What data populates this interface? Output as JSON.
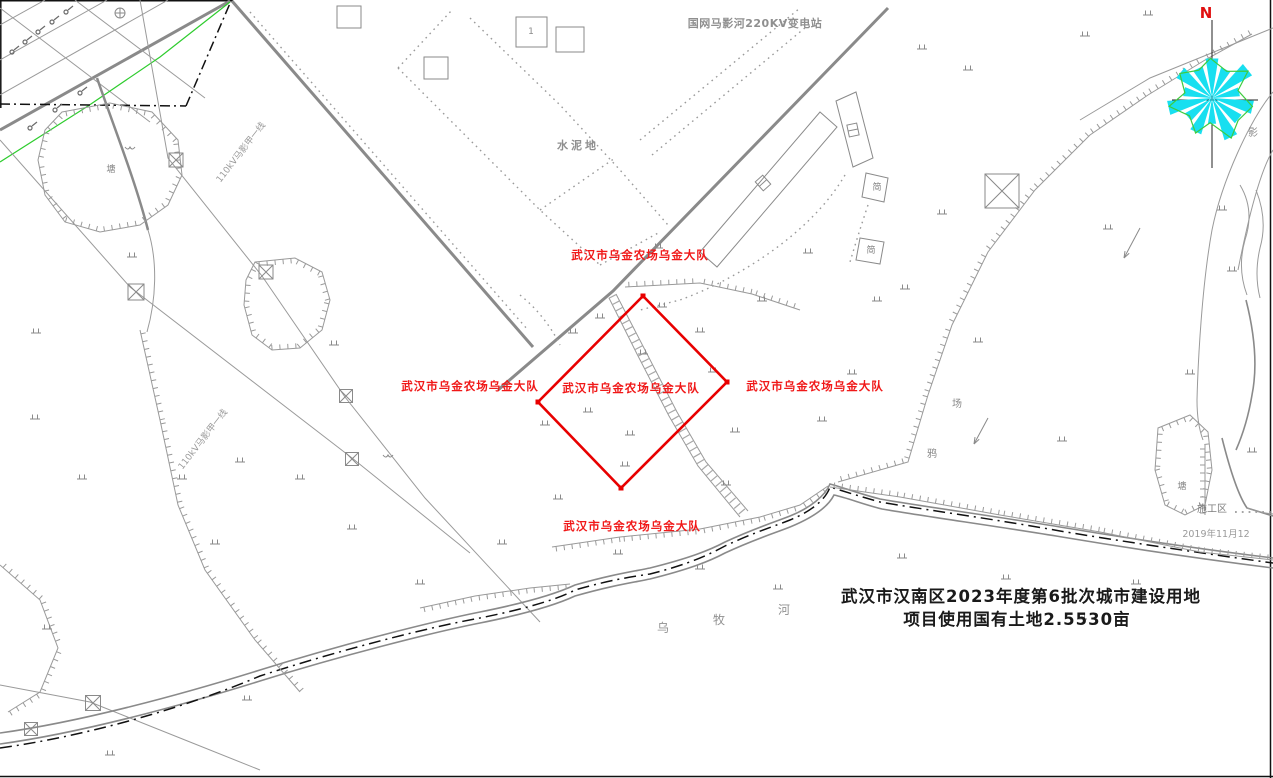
{
  "map_title": "cadastral-parcel-map",
  "compass": {
    "north_label": "N",
    "rose_color": "#18dff0",
    "rose_outline_color": "#3ecc3e",
    "north_color": "#e01010"
  },
  "parcel": {
    "outline_color": "#e80000"
  },
  "annotation": {
    "line1": "武汉市汉南区2023年度第6批次城市建设用地",
    "line2": "项目使用国有土地2.5530亩"
  },
  "labels": [
    {
      "name": "substation-label",
      "text": "国网马影河220KV变电站",
      "x": 755,
      "y": 27,
      "size": 11,
      "color": "#8f8f8f",
      "weight": 700,
      "ls": 0.5
    },
    {
      "name": "concrete-ground-label",
      "text": "水泥地",
      "x": 578,
      "y": 149,
      "size": 11,
      "color": "#8f8f8f",
      "weight": 700,
      "ls": 3
    },
    {
      "name": "brigade-label-top",
      "text": "武汉市乌金农场乌金大队",
      "x": 640,
      "y": 259,
      "size": 11.5,
      "color": "#f01818",
      "weight": 700,
      "ls": 1
    },
    {
      "name": "brigade-label-left",
      "text": "武汉市乌金农场乌金大队",
      "x": 470,
      "y": 390,
      "size": 11.5,
      "color": "#f01818",
      "weight": 700,
      "ls": 1
    },
    {
      "name": "brigade-label-center",
      "text": "武汉市乌金农场乌金大队",
      "x": 631,
      "y": 392,
      "size": 11.5,
      "color": "#f01818",
      "weight": 700,
      "ls": 1
    },
    {
      "name": "brigade-label-right",
      "text": "武汉市乌金农场乌金大队",
      "x": 815,
      "y": 390,
      "size": 11.5,
      "color": "#f01818",
      "weight": 700,
      "ls": 1
    },
    {
      "name": "brigade-label-bottom",
      "text": "武汉市乌金农场乌金大队",
      "x": 632,
      "y": 530,
      "size": 11.5,
      "color": "#f01818",
      "weight": 700,
      "ls": 1
    },
    {
      "name": "river-name-char-1",
      "text": "乌",
      "x": 663,
      "y": 632,
      "size": 12,
      "color": "#909090"
    },
    {
      "name": "river-name-char-2",
      "text": "牧",
      "x": 719,
      "y": 624,
      "size": 12,
      "color": "#909090"
    },
    {
      "name": "river-name-char-3",
      "text": "河",
      "x": 784,
      "y": 614,
      "size": 12,
      "color": "#909090"
    },
    {
      "name": "pond-label-left",
      "text": "塘",
      "x": 111,
      "y": 172,
      "size": 9,
      "color": "#808080"
    },
    {
      "name": "pond-label-right",
      "text": "塘",
      "x": 1182,
      "y": 489,
      "size": 9,
      "color": "#808080"
    },
    {
      "name": "area-char-1",
      "text": "场",
      "x": 957,
      "y": 407,
      "size": 10,
      "color": "#8a8a8a"
    },
    {
      "name": "area-char-2",
      "text": "鸦",
      "x": 932,
      "y": 457,
      "size": 10,
      "color": "#8a8a8a"
    },
    {
      "name": "area-char-3",
      "text": "影",
      "x": 1253,
      "y": 136,
      "size": 10,
      "color": "#8a8a8a"
    },
    {
      "name": "shed-label-1",
      "text": "简",
      "x": 877,
      "y": 190,
      "size": 9,
      "color": "#808080"
    },
    {
      "name": "shed-label-2",
      "text": "简",
      "x": 871,
      "y": 253,
      "size": 9,
      "color": "#808080"
    },
    {
      "name": "construction-area-label",
      "text": "施工区",
      "x": 1212,
      "y": 512,
      "size": 10,
      "color": "#7d7d7d"
    },
    {
      "name": "survey-date-label",
      "text": "2019年11月12",
      "x": 1216,
      "y": 537,
      "size": 9.5,
      "color": "#9a9a9a"
    },
    {
      "name": "building-number-label",
      "text": "1",
      "x": 531,
      "y": 34,
      "size": 9,
      "color": "#8a8a8a"
    },
    {
      "name": "powerline-label-1",
      "text": "110kV马影甲一线",
      "x": 243,
      "y": 154,
      "size": 9,
      "color": "#9a9a9a",
      "rot": -52
    },
    {
      "name": "powerline-label-2",
      "text": "110kV马影甲一线",
      "x": 205,
      "y": 441,
      "size": 9,
      "color": "#9a9a9a",
      "rot": -52
    }
  ]
}
